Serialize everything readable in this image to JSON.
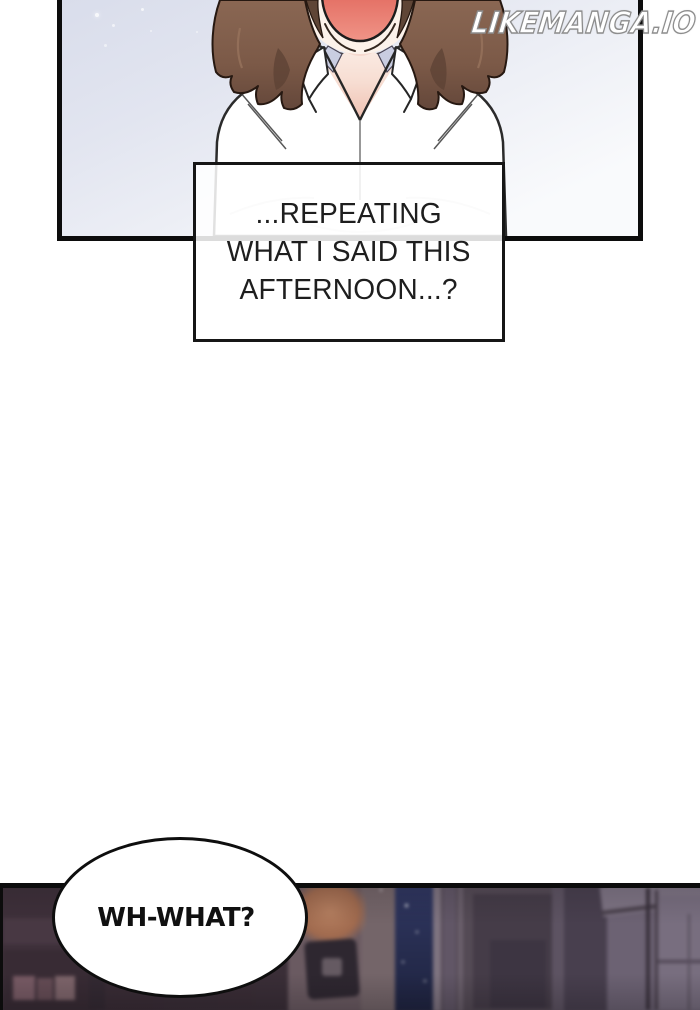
{
  "watermark": {
    "text": "LIKEMANGA.IO"
  },
  "panels": {
    "top": {
      "caption": {
        "line1": "...REPEATING",
        "line2": "WHAT I SAID THIS",
        "line3": "AFTERNOON...?"
      }
    },
    "bottom": {
      "speech": "WH-WHAT?"
    }
  },
  "colors": {
    "panel_border": "#0c0c0c",
    "top_bg_start": "#d9ddeb",
    "top_bg_end": "#f9fafc",
    "mouth_red": "#e26a5f",
    "hair_brown": "#7b5947",
    "collar_lavender": "#c9cde1",
    "skin": "#fcf2ea",
    "night_window": "#2a3052",
    "bottom_scene_base": "#4e4250",
    "caption_text": "#1e1e1e",
    "bubble_text": "#101010",
    "watermark_fill": "#ffffff",
    "watermark_outline": "#8d8d8d"
  }
}
